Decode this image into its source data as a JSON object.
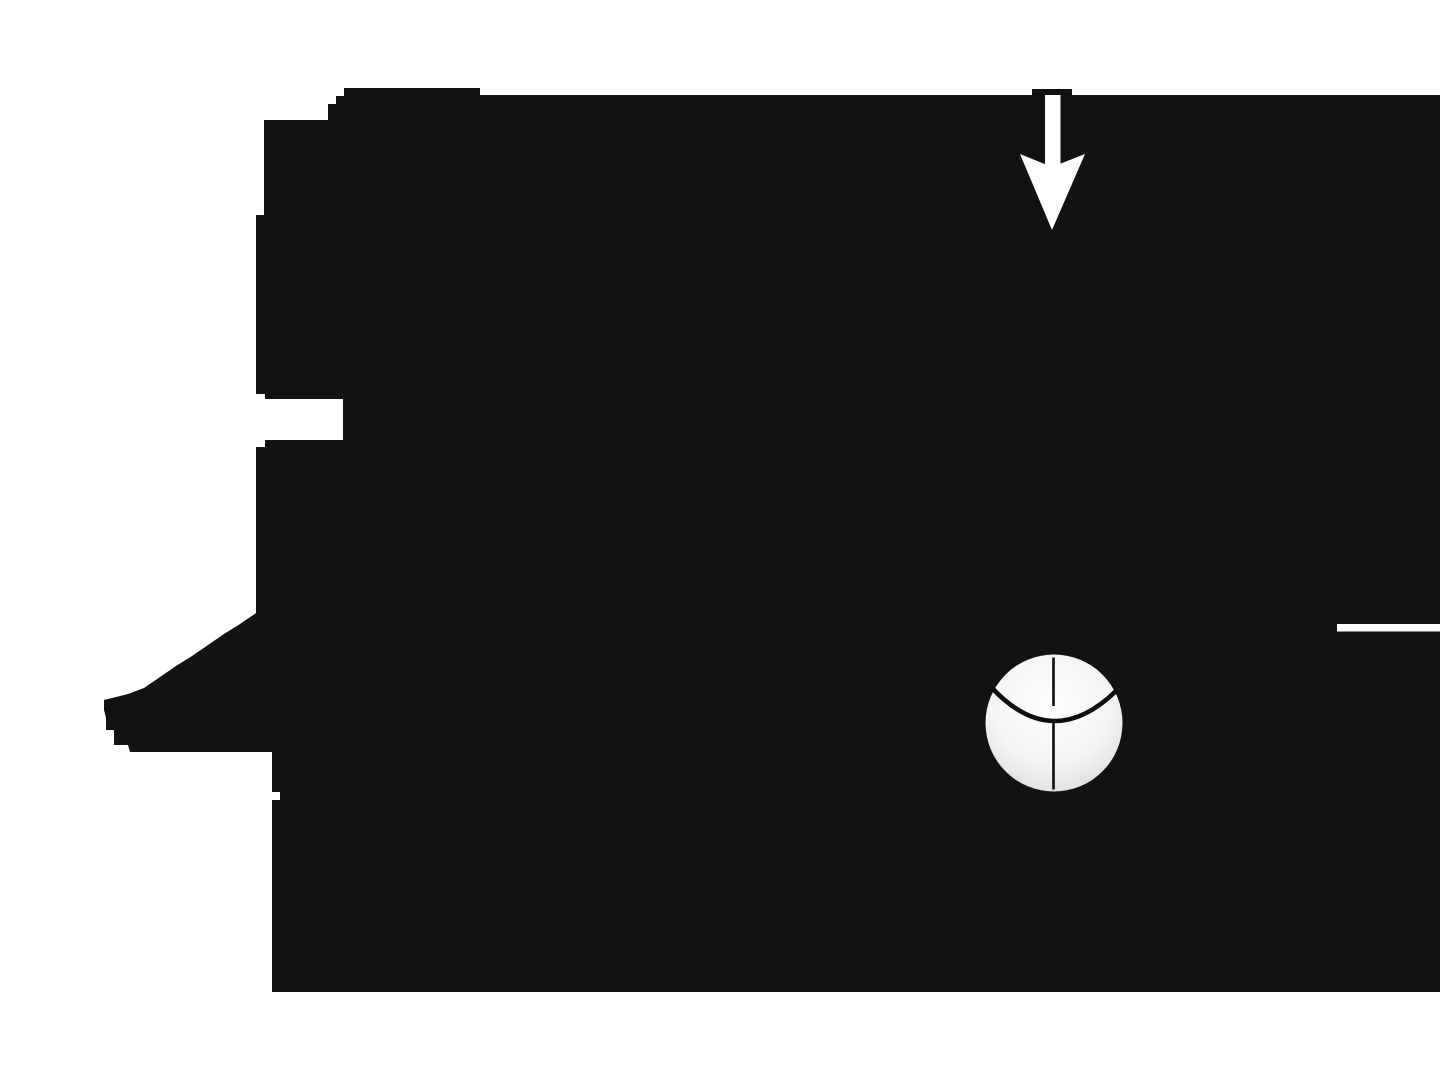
{
  "canvas": {
    "width": 1440,
    "height": 1080
  },
  "colors": {
    "background": "#ffffff",
    "ink": "#121210",
    "white": "#ffffff",
    "ball_center": "#ffffff",
    "ball_mid": "#f4f4f4",
    "ball_edge": "#d4d5d4",
    "line": "#0e0e0c"
  },
  "silhouette": {
    "path": "M 344,88 L 480,88 L 480,95 L 1440,95 L 1440,992 L 272,992 L 272,800 L 280,800 L 280,792 L 272,792 L 272,752 L 130,752 L 128,745 L 114,745 L 114,730 L 106,730 L 106,718 L 104,710 L 104,700 L 112,698 L 128,694 L 144,688 L 160,677 L 176,666 L 192,656 L 208,645 L 224,634 L 240,624 L 256,613 L 256,447 L 265,447 L 265,440 L 343,440 L 343,399 L 265,399 L 265,394 L 256,394 L 256,215 L 264,215 L 264,120 L 328,120 L 328,104 L 336,104 L 336,96 L 344,96 Z"
  },
  "down_arrow": {
    "cap_path": "M 1032,89 L 1072,89 L 1072,95 L 1032,95 Z",
    "stem_path": "M 1045,95 L 1060.5,95 L 1060.5,167 L 1045,167 Z",
    "head_path": "M 1020,154 L 1052,167 L 1085,154 L 1052,230 Z"
  },
  "ball": {
    "circle_path": "M 985.5,723 a 68.5,68.5 0 1 0 137,0 a 68.5,68.5 0 1 0 -137,0 Z",
    "meridian_path": "M 1053.5,657.5 L 1053.5,706 M 1053.5,722 L 1053.5,789.5",
    "meridian_width": "2.6",
    "equator_path": "M 993,689 Q 1053,752 1116,691",
    "equator_width": "4.6"
  },
  "edge_dash": {
    "path": "M 1337,624 L 1440,624 L 1440,631.5 L 1337,631.5 Z"
  }
}
